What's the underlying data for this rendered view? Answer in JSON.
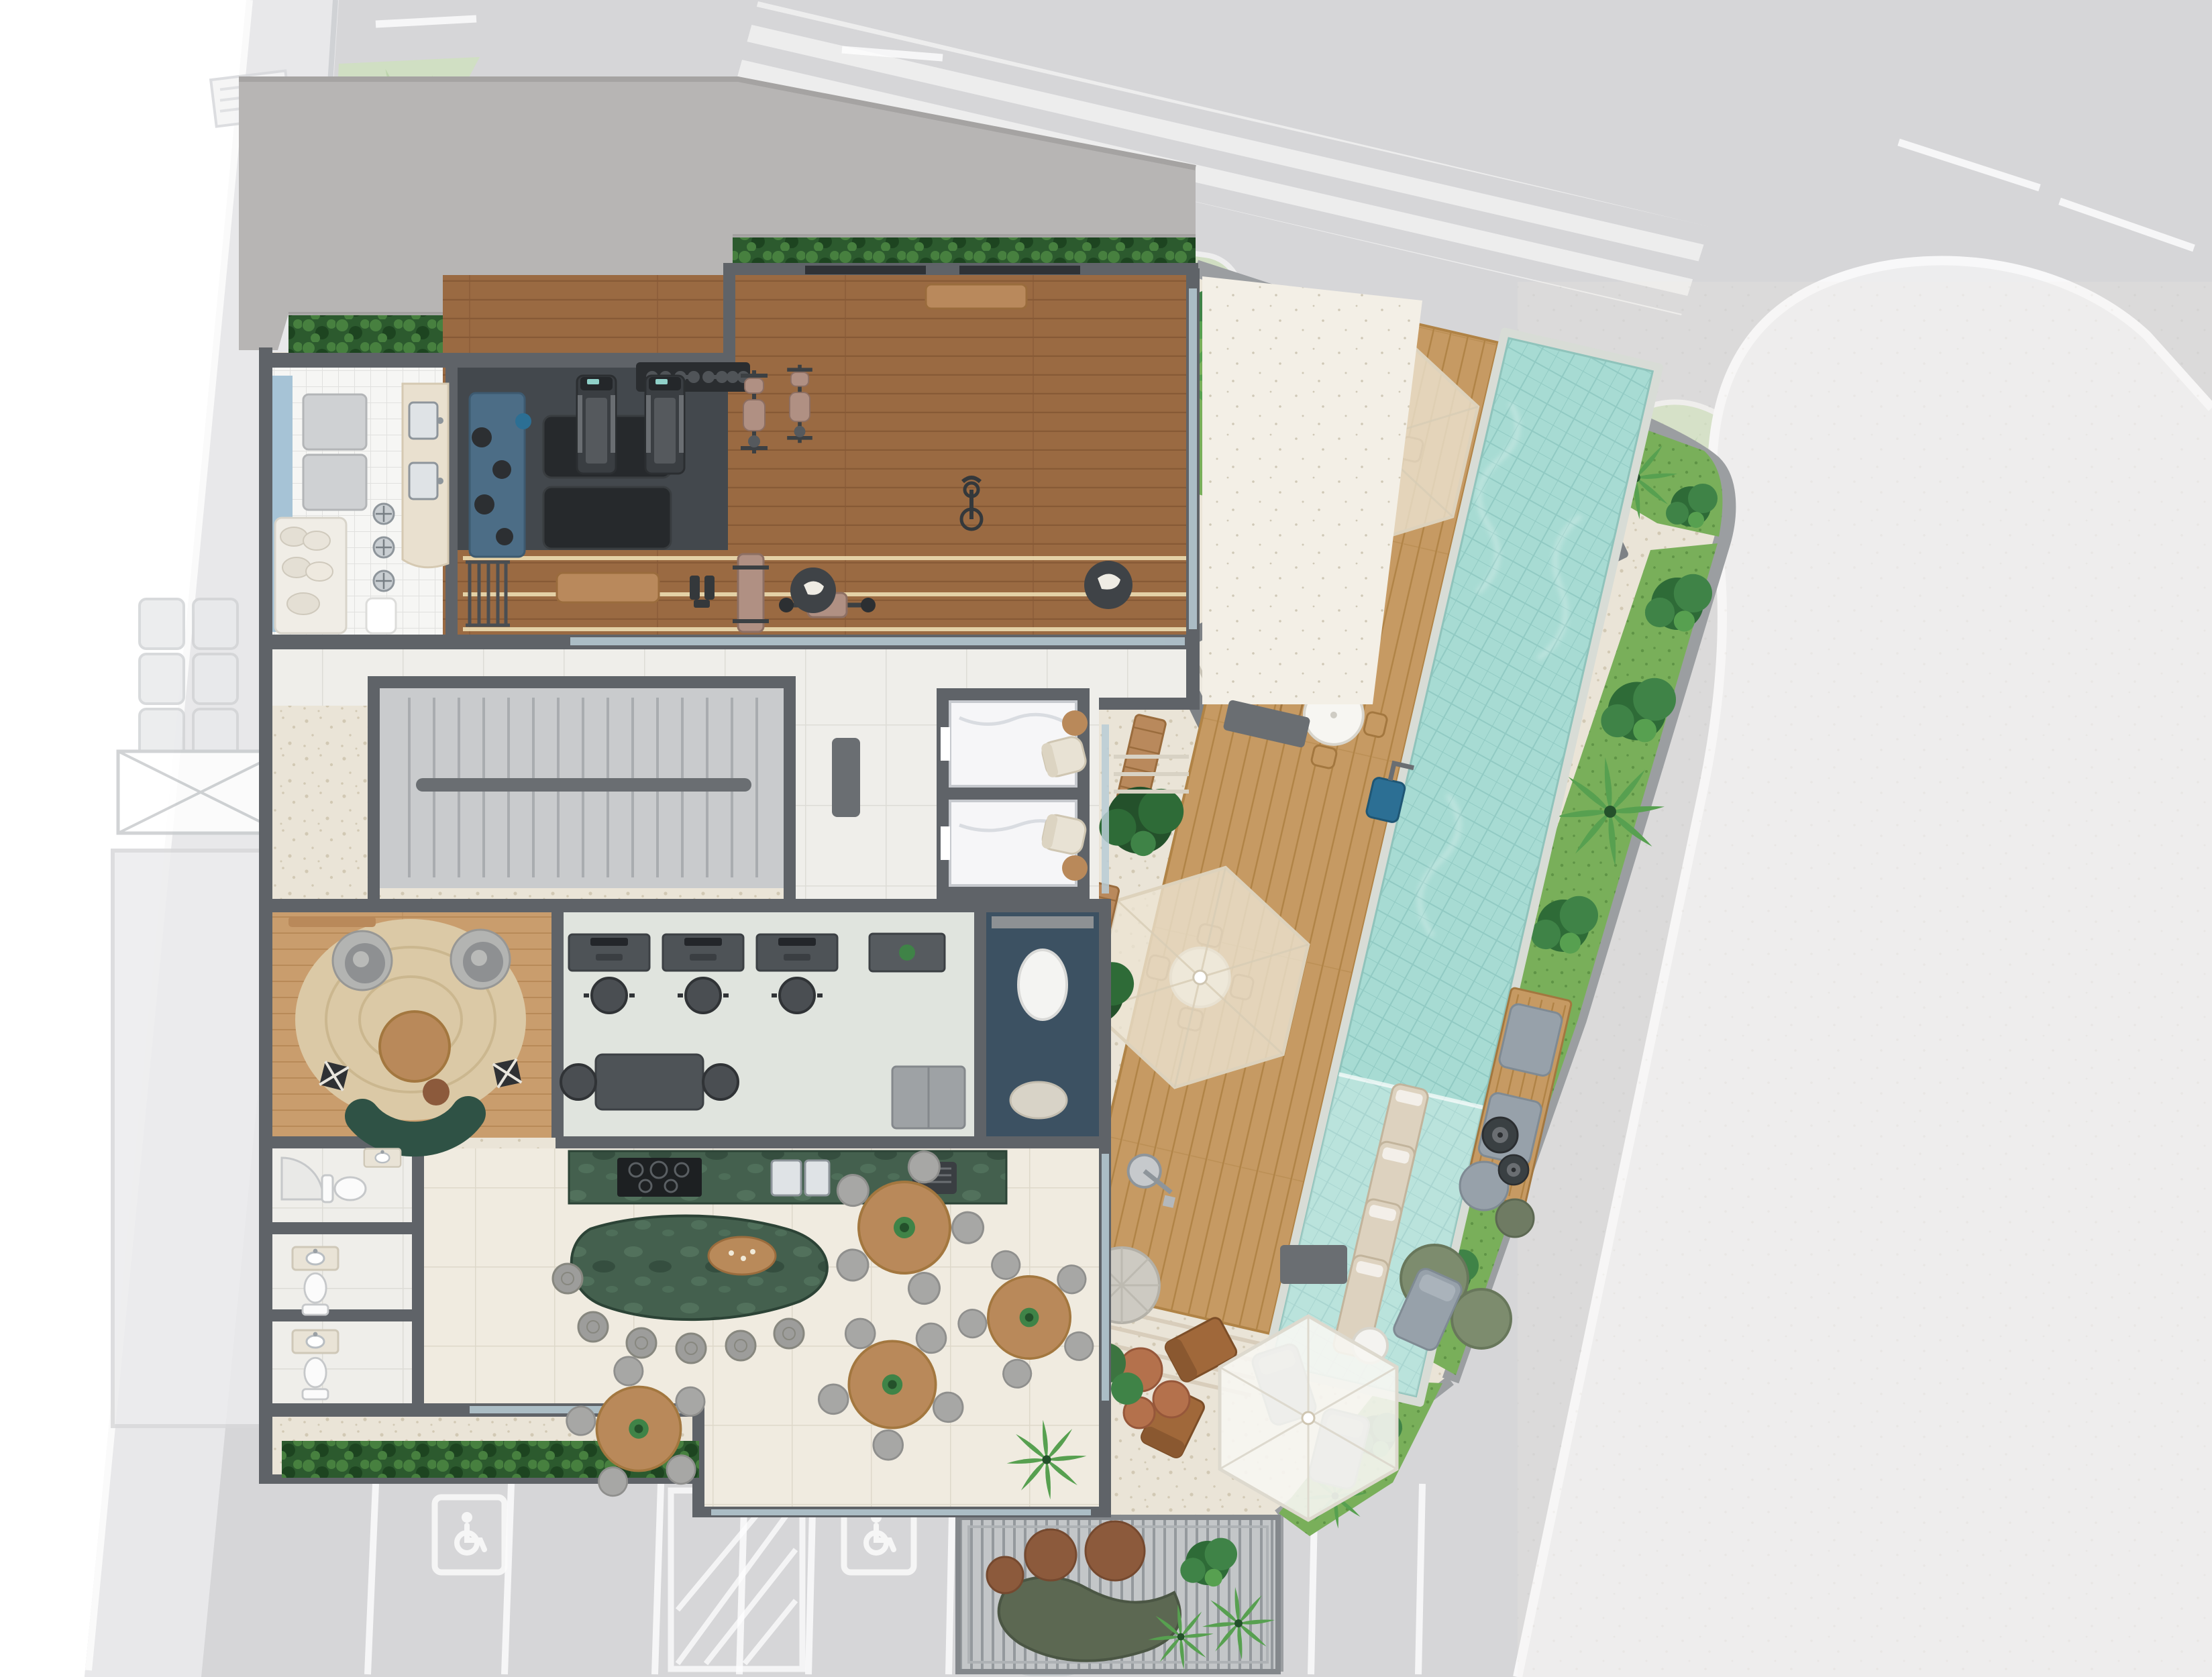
{
  "plan": {
    "type": "architectural-site-plan",
    "floor": "ground-floor-leisure-deck",
    "visible_text": [],
    "areas": [
      {
        "id": "street",
        "name": "street-with-lane-markings"
      },
      {
        "id": "street-parking",
        "name": "angled-street-parking-stalls"
      },
      {
        "id": "sidewalk",
        "name": "sidewalk"
      },
      {
        "id": "corner-sidewalk",
        "name": "rounded-corner-sidewalk-island"
      },
      {
        "id": "slab",
        "name": "building-marquee-slab"
      },
      {
        "id": "spa",
        "name": "spa-shower-room"
      },
      {
        "id": "training",
        "name": "functional-training-zone"
      },
      {
        "id": "gym",
        "name": "fitness-room"
      },
      {
        "id": "corridor",
        "name": "entry-corridor"
      },
      {
        "id": "stairs",
        "name": "stair-hall"
      },
      {
        "id": "elevators",
        "name": "elevator-bank"
      },
      {
        "id": "lobby",
        "name": "lobby"
      },
      {
        "id": "lounge",
        "name": "lounge"
      },
      {
        "id": "coworking",
        "name": "coworking-room"
      },
      {
        "id": "pantry",
        "name": "navy-pantry-nook"
      },
      {
        "id": "party",
        "name": "party-room"
      },
      {
        "id": "island",
        "name": "green-granite-island"
      },
      {
        "id": "wc",
        "name": "restrooms"
      },
      {
        "id": "bbq",
        "name": "bbq-terrace"
      },
      {
        "id": "deck",
        "name": "pool-wood-deck"
      },
      {
        "id": "pool",
        "name": "swimming-pool"
      },
      {
        "id": "wetdeck",
        "name": "wet-deck-with-loungers"
      },
      {
        "id": "ramp",
        "name": "access-ramp"
      },
      {
        "id": "gardens",
        "name": "tropical-garden-beds"
      },
      {
        "id": "pergola",
        "name": "pergola-lounge"
      },
      {
        "id": "cabana",
        "name": "cabana-umbrella"
      },
      {
        "id": "parking",
        "name": "surface-parking-lot"
      }
    ],
    "icons": [
      {
        "name": "wheelchair-icon",
        "meaning": "accessible parking stall"
      }
    ],
    "inventory": {
      "treadmills": 2,
      "strength_machines": 3,
      "exercise_bike": 1,
      "stepper": 1,
      "training_mats": 2,
      "kettlebells": 4,
      "dumbbell_rack": 1,
      "umbrella_table_sets": 2,
      "plain_table_set": 1,
      "in_pool_loungers": 4,
      "pool_lift_chair": 1,
      "outdoor_shower": 1,
      "dining_tables": 4,
      "island_stools": 6,
      "desks": 3,
      "elevators": 2,
      "toilets": 3,
      "accessible_parking_spaces": 2,
      "parked_cars": 1,
      "planter_benches": 3,
      "fire_bowls": 2,
      "pergola_poufs": 3
    }
  },
  "palette": {
    "page": "#ffffff",
    "road": "#d6d6d8",
    "marking": "#ffffff",
    "sidewalk": "#e8e8ea",
    "wedge": "#ededee",
    "curb": "#9b9ea1",
    "median_grass": "#cfe0bf",
    "faded_leaf": "#b5d0a4",
    "faded_leaf2": "#96b886",
    "lot": "#eae4d7",
    "lot_speck": "#d2c9b4",
    "path_light": "#f3efe6",
    "wall": "#5f6368",
    "wall_mid": "#84888c",
    "slab": "#b7b5b4",
    "slab_edge": "#8e8c8b",
    "hedge_a": "#2c5a2e",
    "hedge_b": "#47803f",
    "hedge_c": "#1d4420",
    "grass_a": "#79af5a",
    "grass_b": "#5f9446",
    "leaf_a": "#2e6b37",
    "leaf_b": "#3f8347",
    "leaf_c": "#57a050",
    "leaf_dark": "#24512b",
    "gym_wood": "#9a6a42",
    "gym_line": "#875a36",
    "led": "#f2e3b8",
    "dark_zone": "#43484d",
    "mat_black": "#26292c",
    "mat_blue": "#4c6d86",
    "rack_dark": "#2a2d30",
    "spa_tile": "#f6f6f4",
    "spa_line": "#e1e1df",
    "spa_blue": "#a6c3d6",
    "cream": "#e9e0cf",
    "chrome": "#c9ced2",
    "steel": "#8e959b",
    "corridor": "#d6d7d9",
    "stair_floor": "#c9cbcd",
    "tread": "#a9acaf",
    "rail": "#6a6e72",
    "tile_light": "#efeeea",
    "tile_line": "#dddcd6",
    "elev_cabin": "#f6f6f8",
    "elev_frame": "#9fa3a7",
    "lounge_wood": "#c99d6d",
    "lounge_line": "#b88a58",
    "rug": "#dbc9a6",
    "rug_line": "#cbb78f",
    "sofa_green": "#2f5245",
    "chair_gray": "#a7a7a5",
    "chair_dark": "#3b3b3b",
    "table_wood": "#b9895a",
    "cowork_floor": "#e0e4de",
    "desk_dark": "#4e5357",
    "navy": "#3c5162",
    "oval_white": "#f4f4f2",
    "party_tile": "#f0ebe0",
    "party_line": "#ded8ca",
    "granite_a": "#44604e",
    "granite_b": "#5c7f67",
    "granite_c": "#2c4336",
    "stool_gray": "#9d9d9b",
    "deck_wood": "#c69a63",
    "deck_line": "#b08346",
    "pool_coping": "#d8dcd6",
    "pool_water": "#a7dbd3",
    "pool_tile": "#86c2ba",
    "lounger": "#ddd2bf",
    "lift_blue": "#2c6f94",
    "umbrella": "#ece4d2",
    "umbrella_white": "#f7f6f2",
    "umb_edge": "#d8cdb6",
    "bench_wood": "#b9895c",
    "planter_green": "#3c7440",
    "ottoman": "#cdcac2",
    "lounge_brown": "#a0683a",
    "brick": "#b4714c",
    "concrete_tbl": "#c6c4bc",
    "pergola_base": "#c3c6c8",
    "pergola_slat": "#94999d",
    "pouf_brown": "#8c5a3c",
    "sofa_olive": "#5c6852",
    "cushion_gray": "#97a1aa",
    "pouf_olive": "#6f7b63",
    "pouf_green": "#7d8c6e",
    "fire_dark": "#3a4043",
    "car_body": "#e8eaeb",
    "car_line": "#c3c7ca",
    "car_glass": "#aeb6ba",
    "glass": "#b9ccd6",
    "toilet": "#fbfbfb",
    "fixture": "#c6c8ca",
    "ramp_floor": "#e2ded4",
    "ramp_wall": "#7e8286",
    "icon_white": "#fafafa",
    "ghost": "#e9eaec",
    "ghost_line": "#d2d4d6",
    "tan_pad": "#b09083"
  }
}
